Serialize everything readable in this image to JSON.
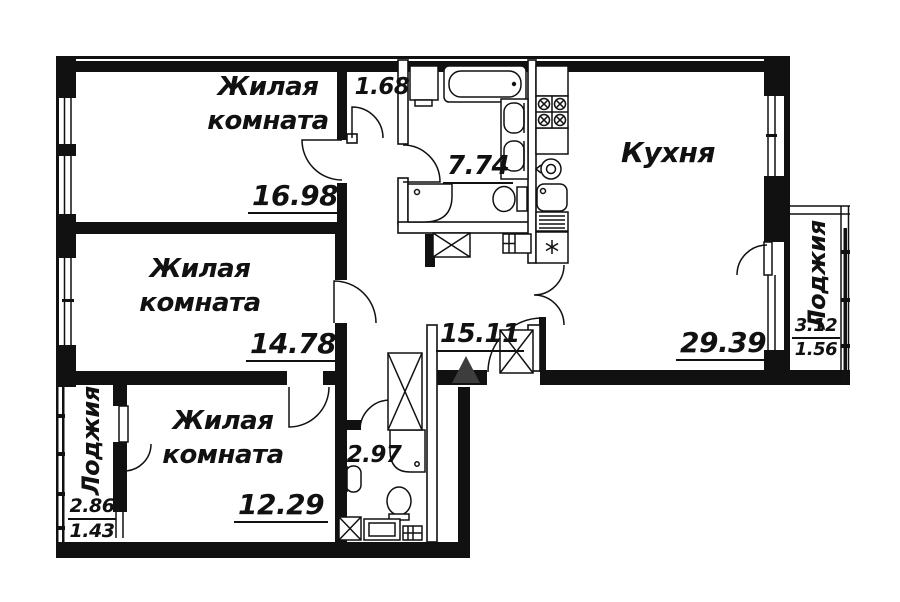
{
  "plan": {
    "rooms": {
      "living1": {
        "name": "Жилая комната",
        "area": "16.98"
      },
      "living2": {
        "name": "Жилая комната",
        "area": "14.78"
      },
      "living3": {
        "name": "Жилая комната",
        "area": "12.29"
      },
      "kitchen": {
        "name": "Кухня",
        "area": "29.39"
      },
      "bathroom": {
        "area": "7.74"
      },
      "hallway": {
        "area": "15.11"
      },
      "closet": {
        "area": "1.68"
      },
      "wc": {
        "area": "2.97"
      }
    },
    "loggias": {
      "right": {
        "name": "Лоджия",
        "area_total": "3.12",
        "area_reduced": "1.56"
      },
      "left": {
        "name": "Лоджия",
        "area_total": "2.86",
        "area_reduced": "1.43"
      }
    },
    "icons": {
      "entrance_marker": "filled-triangle-up",
      "shaft": "crossed-box",
      "fridge": "asterisk-box"
    },
    "colors": {
      "line": "#111111",
      "entrance_marker": "#3d3d3d",
      "background": "#ffffff"
    }
  }
}
